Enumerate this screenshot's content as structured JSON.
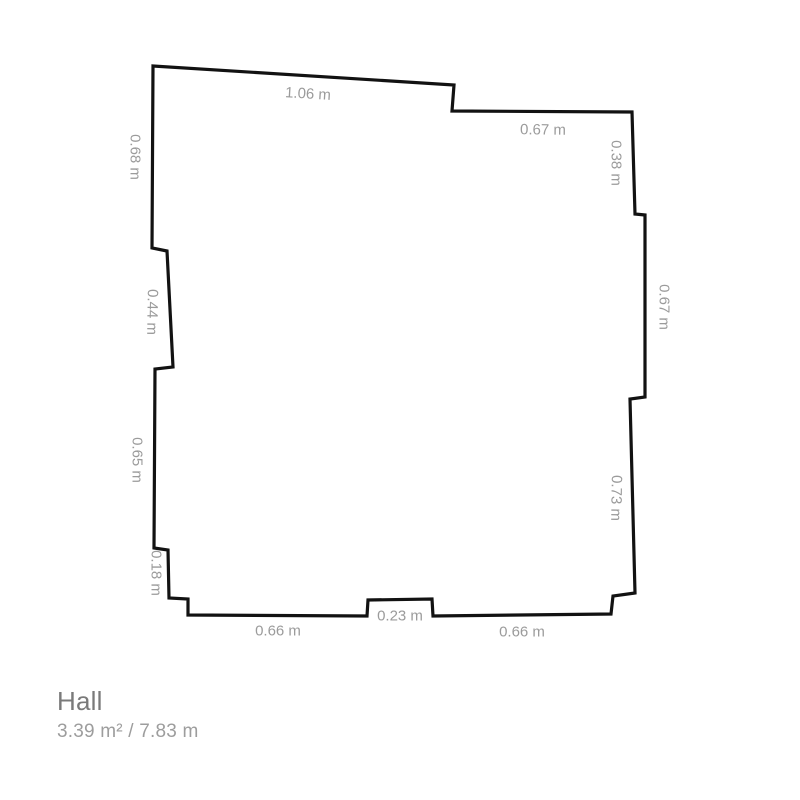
{
  "colors": {
    "background": "#ffffff",
    "wall": "#121212",
    "dimension_label": "#9b9b9b",
    "room_name": "#7a7a7a",
    "room_stats": "#9d9d9d"
  },
  "floorplan": {
    "unit": "m",
    "stroke_width": 3.2,
    "vertices": [
      [
        153,
        66
      ],
      [
        454,
        85
      ],
      [
        452,
        111
      ],
      [
        632,
        112
      ],
      [
        635,
        214
      ],
      [
        645,
        215
      ],
      [
        645,
        397
      ],
      [
        630,
        399
      ],
      [
        635,
        593
      ],
      [
        613,
        596
      ],
      [
        611,
        614
      ],
      [
        433,
        616
      ],
      [
        432,
        599
      ],
      [
        368,
        600
      ],
      [
        367,
        616
      ],
      [
        188,
        615
      ],
      [
        188,
        599
      ],
      [
        169,
        598
      ],
      [
        168,
        550
      ],
      [
        154,
        548
      ],
      [
        155,
        369
      ],
      [
        173,
        367
      ],
      [
        167,
        251
      ],
      [
        152,
        248
      ]
    ],
    "dimensions": [
      {
        "label": "1.06 m",
        "x": 308,
        "y": 94,
        "rotation": 3.5
      },
      {
        "label": "0.67 m",
        "x": 543,
        "y": 130,
        "rotation": 0.5
      },
      {
        "label": "0.38 m",
        "x": 616,
        "y": 163,
        "rotation": 90
      },
      {
        "label": "0.67 m",
        "x": 664,
        "y": 307,
        "rotation": 90
      },
      {
        "label": "0.73 m",
        "x": 616,
        "y": 498,
        "rotation": 91
      },
      {
        "label": "0.66 m",
        "x": 522,
        "y": 632,
        "rotation": 0
      },
      {
        "label": "0.23 m",
        "x": 400,
        "y": 616,
        "rotation": 0
      },
      {
        "label": "0.66 m",
        "x": 278,
        "y": 631,
        "rotation": 0
      },
      {
        "label": "0.18 m",
        "x": 156,
        "y": 573,
        "rotation": 90
      },
      {
        "label": "0.65 m",
        "x": 137,
        "y": 460,
        "rotation": 90
      },
      {
        "label": "0.44 m",
        "x": 152,
        "y": 312,
        "rotation": 91
      },
      {
        "label": "0.68 m",
        "x": 135,
        "y": 157,
        "rotation": 90
      }
    ]
  },
  "room": {
    "name": "Hall",
    "area": "3.39 m²",
    "perimeter": "7.83 m",
    "stats": "3.39 m² / 7.83 m"
  }
}
